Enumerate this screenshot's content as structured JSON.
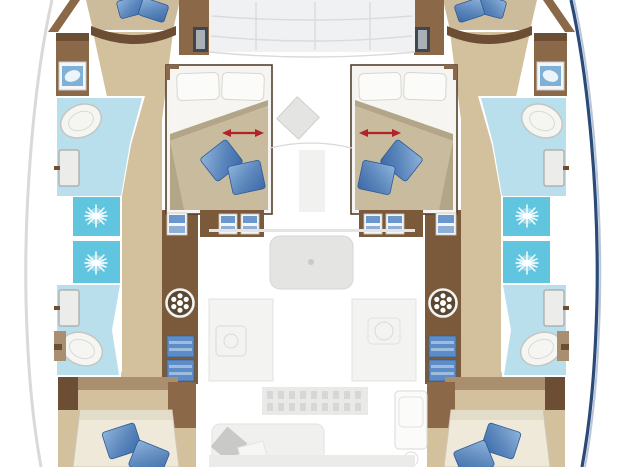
{
  "document": {
    "kind": "catamaran-yacht-floorplan-top-view",
    "visible_text": [],
    "symmetry": "port and starboard hulls mirrored about vertical centerline",
    "center_section_state": "saloon/galley drawn as faded ghost under-layer"
  },
  "icons": [
    "shower-jet-icon",
    "washing-machine-icon",
    "toilet-icon",
    "washbasin-icon",
    "double-arrow-icon",
    "porthole-window-icon",
    "door-swing-icon"
  ],
  "elements": {
    "port_hull": [
      "bow-cabin-bed",
      "bow-corridor",
      "forward-wardrobe",
      "forward-head",
      "shower-cells",
      "washing-machine-cabinet",
      "towel-shelves",
      "aft-head",
      "aft-corridor",
      "aft-cabin-bed",
      "forward-cabin-double-bed"
    ],
    "starboard_hull": [
      "mirror-of-port-hull"
    ],
    "center": [
      "coachroof-skylight-grid",
      "ghost-cushion",
      "ghost-table",
      "ghost-galley-counters",
      "ghost-stove-grid",
      "ghost-sofa",
      "ghost-fridge"
    ]
  },
  "colors": {
    "floor_tan": "#d3c09d",
    "bed_tan": "#cdbc9c",
    "blanket_tan": "#c9bb9e",
    "blanket_shadow": "#b3a588",
    "mattress_cream": "#efe9da",
    "mattress_edge": "#cfc8b8",
    "furniture_brown": "#8a6848",
    "furniture_mid": "#7b5a3c",
    "furniture_dark": "#6b4e34",
    "furniture_light": "#a98f6f",
    "bathroom_blue": "#b9dfec",
    "shower_cyan": "#62c5df",
    "fixture_white": "#f5f5f2",
    "fixture_stroke": "#c4c6c2",
    "cabin_white": "#f5f4f1",
    "sheet_white": "#f6f5f1",
    "pillow_white": "#fbfbf9",
    "pillow_blue_dark": "#2d5a95",
    "pillow_blue_pale": "#9cbce0",
    "towel_blue": "#5e8cc6",
    "step_blue": "#6b97cd",
    "sink_blue": "#7fb0d8",
    "door_fill": "#ececea",
    "door_stroke": "#a8a8a4",
    "ghost_fill": "#f1f1ef",
    "ghost_mid": "#e4e4e2",
    "ghost_line": "#d8d8d6",
    "ghost_dark": "#c9c9c7",
    "skylight": "#f0f1f2",
    "skylight_line": "#d9dbdc",
    "arrow_red": "#b22325",
    "window_dark": "#3e4750",
    "window_light": "#aab0b4",
    "hull_navy": "#2a4a78",
    "hull_navy_light": "#b9c6da",
    "hull_gray": "#d9d9d6"
  }
}
